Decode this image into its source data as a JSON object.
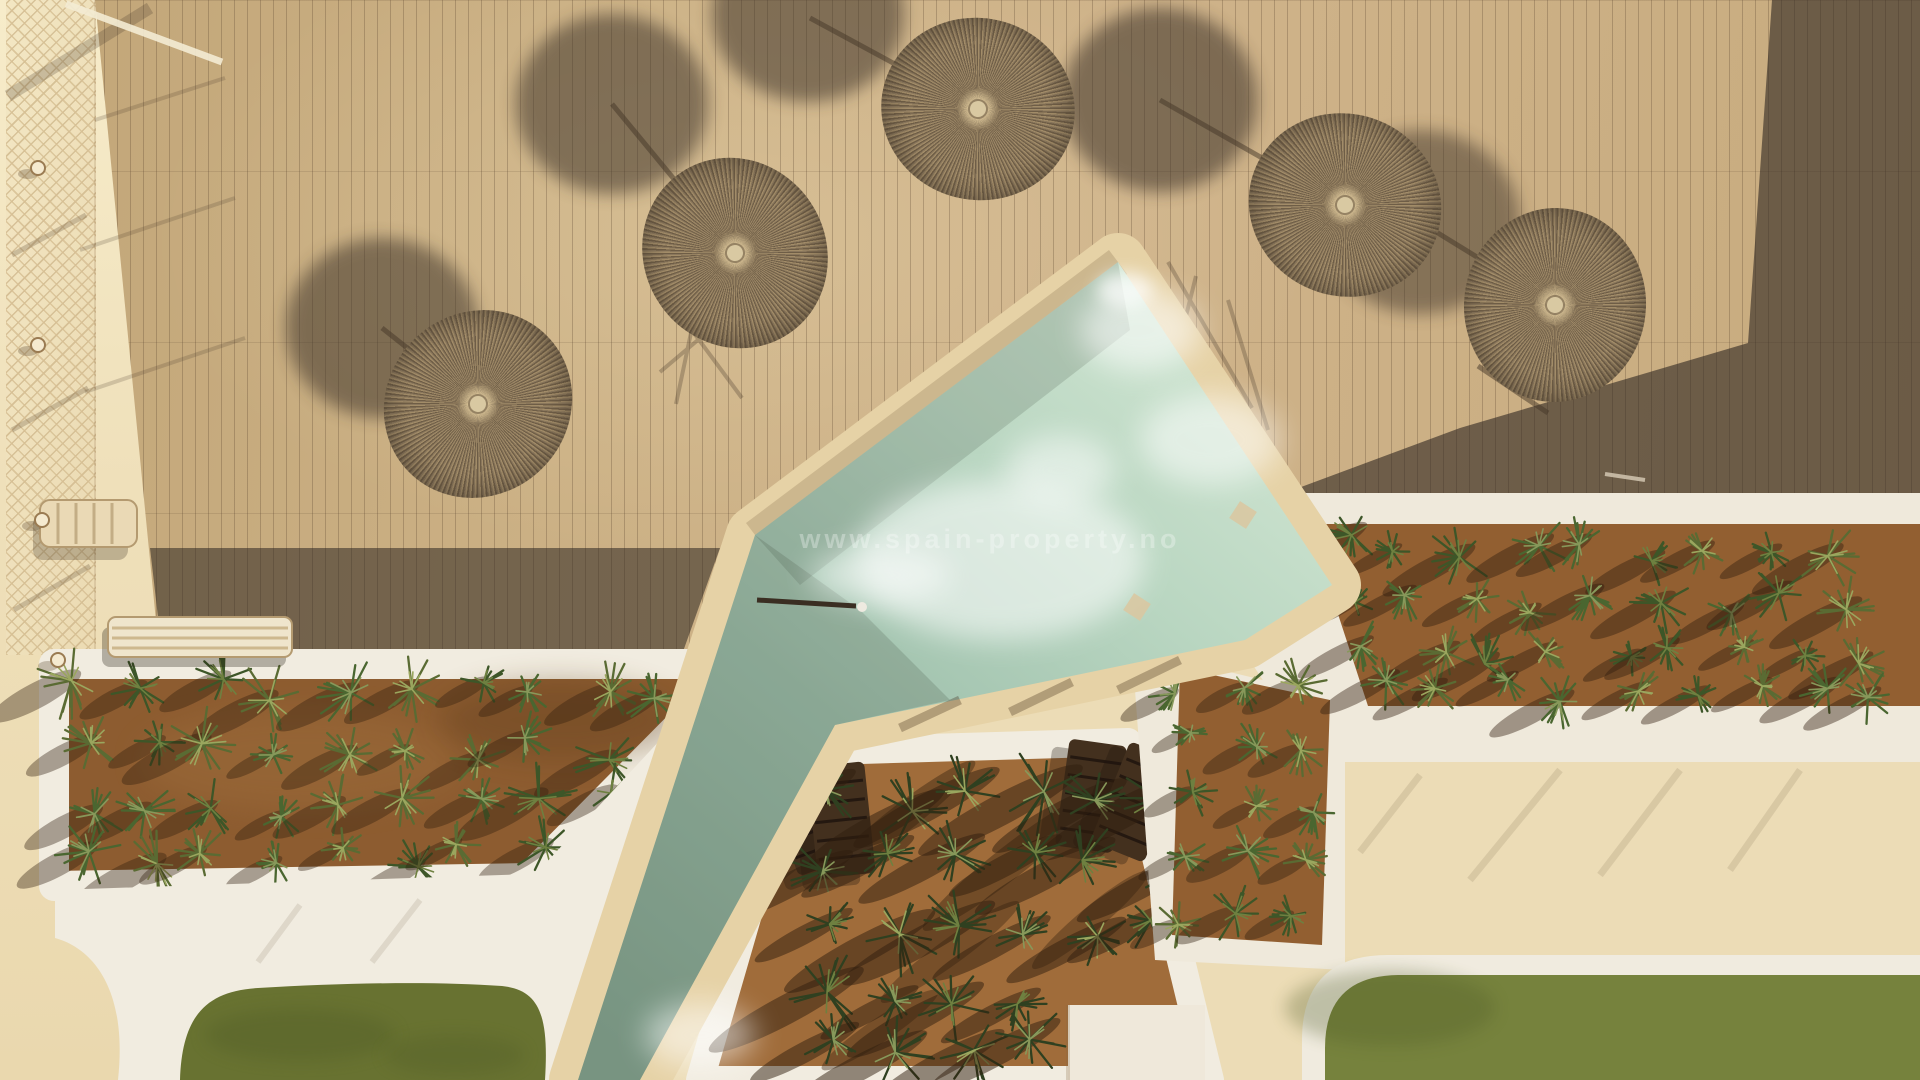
{
  "image": {
    "type": "aerial-drone-photo",
    "subject": "Resort pool deck seen from directly above: wooden deck with straw parasols and long shadows, diagonal pool, white-walled planters with succulents, sun loungers and lawns",
    "width": 1920,
    "height": 1080
  },
  "watermark": {
    "text": "www.spain-property.no"
  },
  "palette": {
    "deck": "#c9ad81",
    "deck_shadow": "#2e2721",
    "pale_paving": "#ecdcb6",
    "bright_paving": "#f7ecca",
    "white_wall": "#f1ece0",
    "pool_coping": "#e6d2a6",
    "water_light": "#d3e7d4",
    "water_mid": "#a9c9b4",
    "water_dark": "#86a793",
    "soil_left": "#8d5c30",
    "soil_center": "#a06c3a",
    "soil_right": "#925f31",
    "lawn_left": "#687231",
    "lawn_right": "#76823d",
    "straw": "#8f7c60",
    "umbrella_shadow": "#3f342a"
  },
  "objects": {
    "umbrellas": {
      "count": 5,
      "label": "round straw parasols"
    },
    "umbrella_shadows": {
      "count": 5,
      "label": "oval parasol shadows on deck"
    },
    "pool": {
      "label": "diamond-headed pool with diagonal channel"
    },
    "planters": {
      "count": 3,
      "label": "white-walled planters with aloes and palms"
    },
    "loungers": {
      "count": 5,
      "label": "wooden sun loungers in sunken terrace"
    },
    "stacked_sunbeds": {
      "count": 1,
      "label": "stacked pale sunbeds"
    },
    "lawns": {
      "count": 2,
      "label": "artificial grass areas"
    },
    "net_fence": {
      "label": "rope-net fence with posts along left walkway"
    },
    "building_shadow": {
      "label": "large diagonal building shadow over right deck"
    }
  }
}
